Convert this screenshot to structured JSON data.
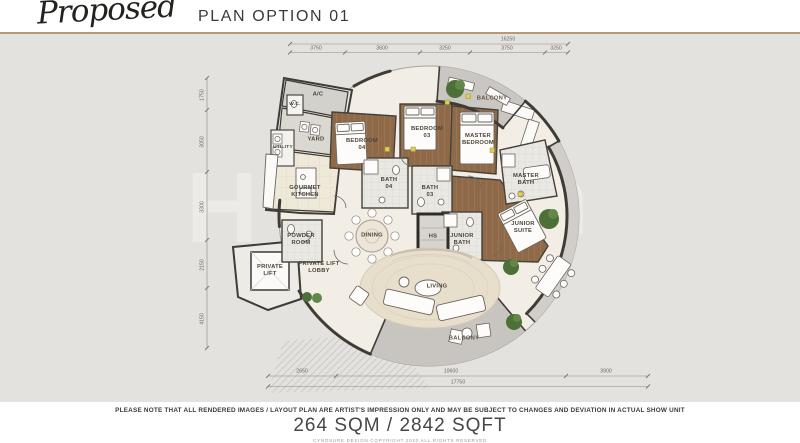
{
  "header": {
    "title_script": "Proposed",
    "title_rest": "PLAN OPTION 01"
  },
  "plan": {
    "rooms": [
      {
        "id": "ac",
        "label": "A/C"
      },
      {
        "id": "wc",
        "label": "W.C."
      },
      {
        "id": "yard",
        "label": "YARD"
      },
      {
        "id": "utility",
        "label": "UTILITY"
      },
      {
        "id": "gourmet-kitchen",
        "label": "GOURMET KITCHEN"
      },
      {
        "id": "bedroom-04",
        "label": "BEDROOM 04"
      },
      {
        "id": "bath-04",
        "label": "BATH 04"
      },
      {
        "id": "bedroom-03",
        "label": "BEDROOM 03"
      },
      {
        "id": "bath-03",
        "label": "BATH 03"
      },
      {
        "id": "master-bedroom",
        "label": "MASTER BEDROOM"
      },
      {
        "id": "master-bath",
        "label": "MASTER BATH"
      },
      {
        "id": "balcony-top",
        "label": "BALCONY"
      },
      {
        "id": "junior-suite",
        "label": "JUNIOR SUITE"
      },
      {
        "id": "junior-bath",
        "label": "JUNIOR BATH"
      },
      {
        "id": "hs",
        "label": "HS"
      },
      {
        "id": "dining",
        "label": "DINING"
      },
      {
        "id": "powder-room",
        "label": "POWDER ROOM"
      },
      {
        "id": "private-lift",
        "label": "PRIVATE LIFT"
      },
      {
        "id": "private-lift-lobby",
        "label": "PRIVATE LIFT LOBBY"
      },
      {
        "id": "living",
        "label": "LIVING"
      },
      {
        "id": "balcony-bottom",
        "label": "BALCONY"
      }
    ],
    "dimensions": {
      "top_overall": "16250",
      "top_segments": [
        "3750",
        "3600",
        "3250",
        "3750",
        "3250"
      ],
      "left_segments": [
        "1750",
        "3050",
        "3300",
        "2150",
        "4150"
      ],
      "bottom_segments": [
        "2650",
        "10600",
        "3900"
      ],
      "bottom_overall": "17750"
    }
  },
  "watermark": {
    "letters": [
      "H",
      "n"
    ]
  },
  "footer": {
    "disclaimer": "PLEASE NOTE THAT ALL RENDERED IMAGES / LAYOUT PLAN  ARE ARTIST'S IMPRESSION ONLY AND MAY BE SUBJECT TO CHANGES AND DEVIATION IN ACTUAL SHOW UNIT",
    "area": "264 SQM / 2842 SQFT",
    "copyright": "CYNOSURE DESIGN    COPYRIGHT 2020    ALL RIGHTS RESERVED"
  },
  "colors": {
    "accent_rule": "#b49a7c",
    "wood_floor": "#8e6a49",
    "balcony_gray": "#cac7c2",
    "plan_background": "#f2eee5",
    "canvas_background": "#e4e2df",
    "tree_green": "#4d6f38",
    "wall_dark": "#3f3b36"
  }
}
